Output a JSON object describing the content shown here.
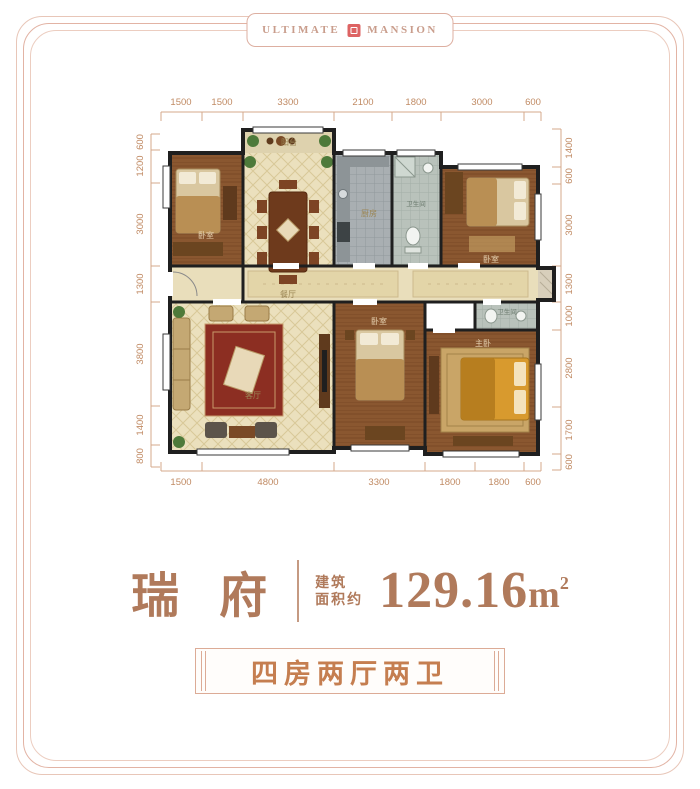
{
  "header": {
    "brand_left": "ULTIMATE",
    "brand_right": "MANSION",
    "logo": "red-seal-icon"
  },
  "floorplan": {
    "dims_top": [
      "1500",
      "1500",
      "3300",
      "2100",
      "1800",
      "3000",
      "600"
    ],
    "dims_bottom": [
      "1500",
      "4800",
      "3300",
      "1800",
      "1800",
      "600"
    ],
    "dims_left": [
      "600",
      "1200",
      "3000",
      "1300",
      "3800",
      "1400",
      "800"
    ],
    "dims_right": [
      "1400",
      "600",
      "3000",
      "1300",
      "1000",
      "2800",
      "1700",
      "600"
    ],
    "rooms": {
      "balcony": "阳台",
      "bedroom_tl": "卧室",
      "dining": "餐厅",
      "kitchen": "厨房",
      "bath_top": "卫生间",
      "bedroom_tr": "卧室",
      "living": "客厅",
      "bedroom_bm": "卧室",
      "master": "主卧",
      "bath_br": "卫生间"
    }
  },
  "title": {
    "name": "瑞 府",
    "area_label_line1": "建筑",
    "area_label_line2": "面积约",
    "area_value": "129.16",
    "area_unit": "m",
    "area_sup": "2"
  },
  "badge": {
    "label": "四房两厅两卫"
  },
  "colors": {
    "frame_line": "#e8c6b8",
    "dimension": "#c08a63",
    "title_text": "#b07a5b",
    "badge_text": "#c57e50",
    "wall": "#1f1f1f",
    "wood_floor": "#8a5730",
    "tile_cream": "#ebe0bd",
    "tile_gray": "#a9afb2",
    "seal_red": "#dd6363"
  }
}
